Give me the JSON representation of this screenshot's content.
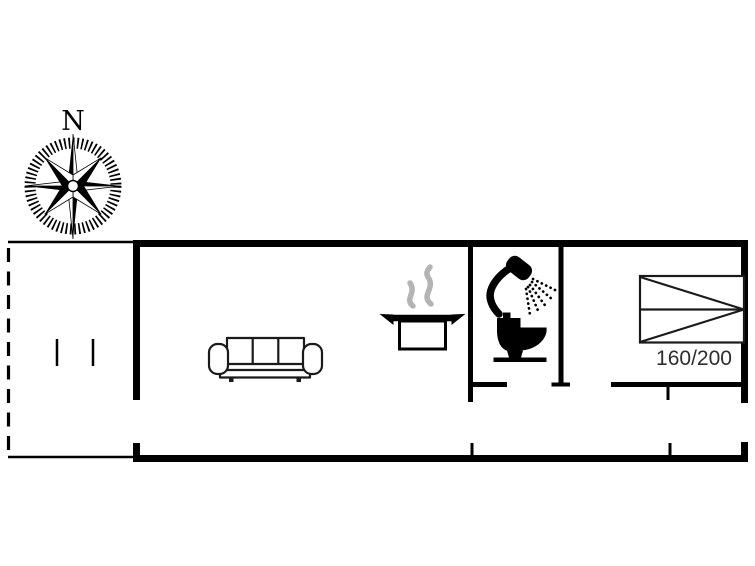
{
  "compass": {
    "north_label": "N"
  },
  "bedroom": {
    "bed_size_label": "160/200"
  },
  "rooms": [
    {
      "name": "terrace"
    },
    {
      "name": "living-room-with-kitchen"
    },
    {
      "name": "bathroom"
    },
    {
      "name": "hallway"
    },
    {
      "name": "bedroom"
    }
  ],
  "icons": [
    {
      "name": "compass-rose-icon"
    },
    {
      "name": "sofa-icon"
    },
    {
      "name": "cooking-pot-icon"
    },
    {
      "name": "steam-icon"
    },
    {
      "name": "shower-icon"
    },
    {
      "name": "toilet-icon"
    },
    {
      "name": "double-bed-icon"
    }
  ],
  "colors": {
    "wall": "#000000",
    "furniture_line": "#1a1a1a",
    "steam": "#b4b4b4",
    "bed_label": "#2e2e2e",
    "background": "#ffffff"
  }
}
